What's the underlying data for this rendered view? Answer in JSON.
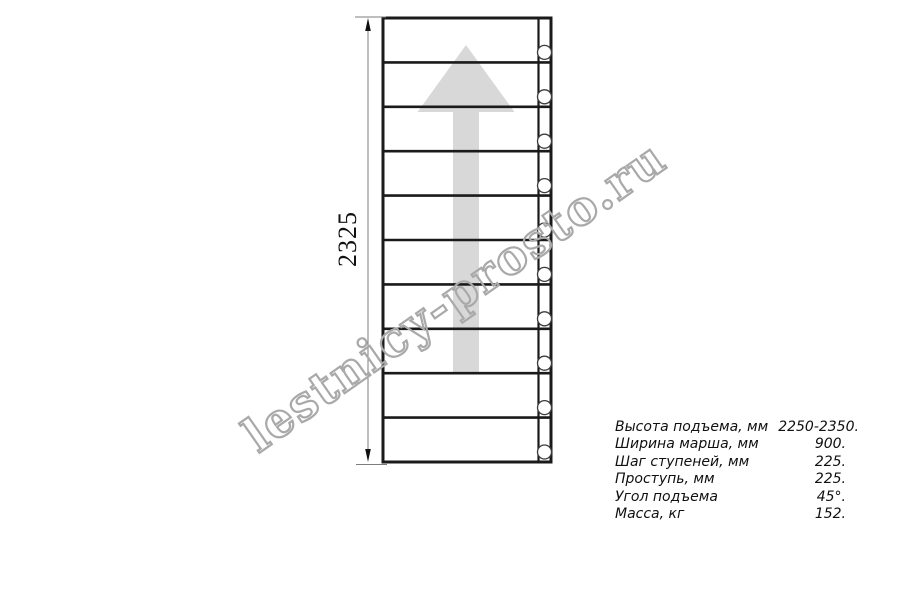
{
  "page": {
    "background": "#ffffff"
  },
  "drawing": {
    "type": "staircase-plan-top-view",
    "steps": 10,
    "mount_holes": 10,
    "dimension_label": "2325",
    "colors": {
      "line": "#1a1a1a",
      "arrow": "#d8d8d8",
      "dimension": "#7d7d7d",
      "watermark": "#a9a9a9"
    }
  },
  "watermark": {
    "text": "lestnicy-prosto.ru"
  },
  "specs": {
    "rows": [
      {
        "label": "Высота подъема, мм",
        "value": "2250-2350."
      },
      {
        "label": "Ширина марша, мм",
        "value": "900."
      },
      {
        "label": "Шаг ступеней, мм",
        "value": "225."
      },
      {
        "label": "Проступь, мм",
        "value": "225."
      },
      {
        "label": "Угол подъема",
        "value": "45°."
      },
      {
        "label": "Масса, кг",
        "value": "152."
      }
    ]
  }
}
